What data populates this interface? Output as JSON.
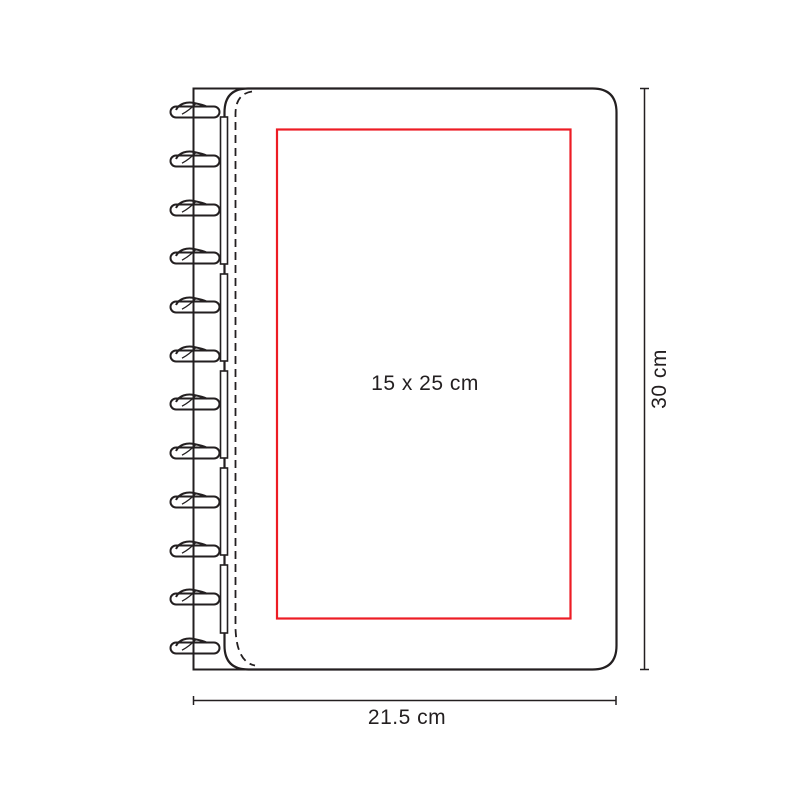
{
  "diagram": {
    "title": "Disc-bound notebook dimension diagram",
    "print_area": {
      "label": "15 x 25 cm"
    },
    "dimensions": {
      "height_label": "30 cm",
      "width_label": "21.5 cm"
    },
    "colors": {
      "outline": "#231f20",
      "print_area_stroke": "#ed1c24",
      "label_text": "#231f20",
      "background": "#ffffff"
    }
  }
}
